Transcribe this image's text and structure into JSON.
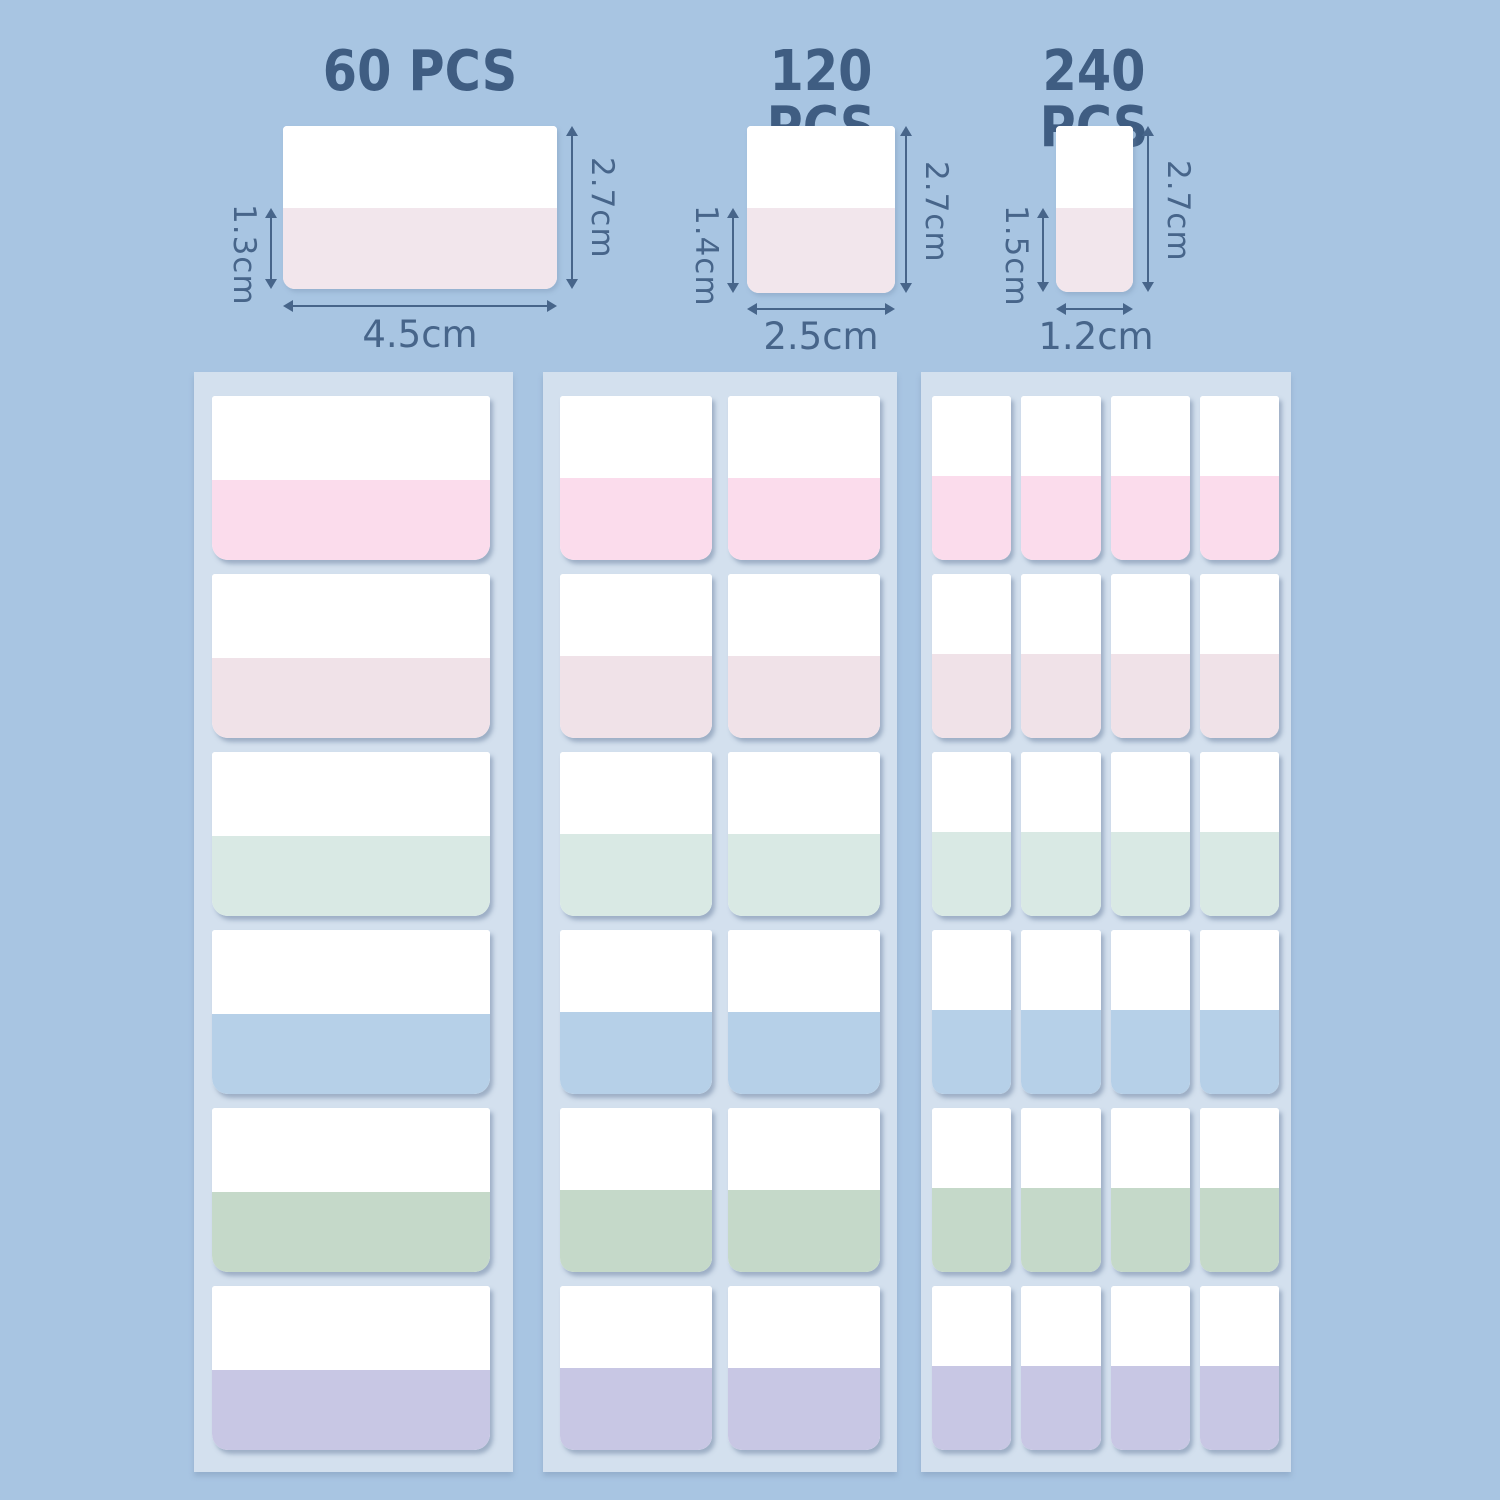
{
  "sizes": [
    {
      "label": "60 PCS",
      "width": "4.5cm",
      "height": "2.7cm",
      "sticky": "1.3cm",
      "sheet_grid": {
        "columns": 1,
        "rows": 6
      }
    },
    {
      "label": "120 PCS",
      "width": "2.5cm",
      "height": "2.7cm",
      "sticky": "1.4cm",
      "sheet_grid": {
        "columns": 2,
        "rows": 6
      }
    },
    {
      "label": "240 PCS",
      "width": "1.2cm",
      "height": "2.7cm",
      "sticky": "1.5cm",
      "sheet_grid": {
        "columns": 4,
        "rows": 6
      }
    }
  ],
  "tab_colors": [
    {
      "name": "pink",
      "hex": "#fbdcec"
    },
    {
      "name": "rose",
      "hex": "#f0e2e8"
    },
    {
      "name": "mint",
      "hex": "#d9e9e4"
    },
    {
      "name": "blue",
      "hex": "#b6d0e8"
    },
    {
      "name": "sage",
      "hex": "#c5d9c9"
    },
    {
      "name": "lavender",
      "hex": "#c8c7e4"
    }
  ],
  "colors": {
    "background": "#a8c5e2",
    "sheet": "#d3e0ee",
    "heading_text": "#3f5d82",
    "dimension_text": "#47658a",
    "diagram_band": "#f2e6ec",
    "tab_top": "#ffffff"
  }
}
